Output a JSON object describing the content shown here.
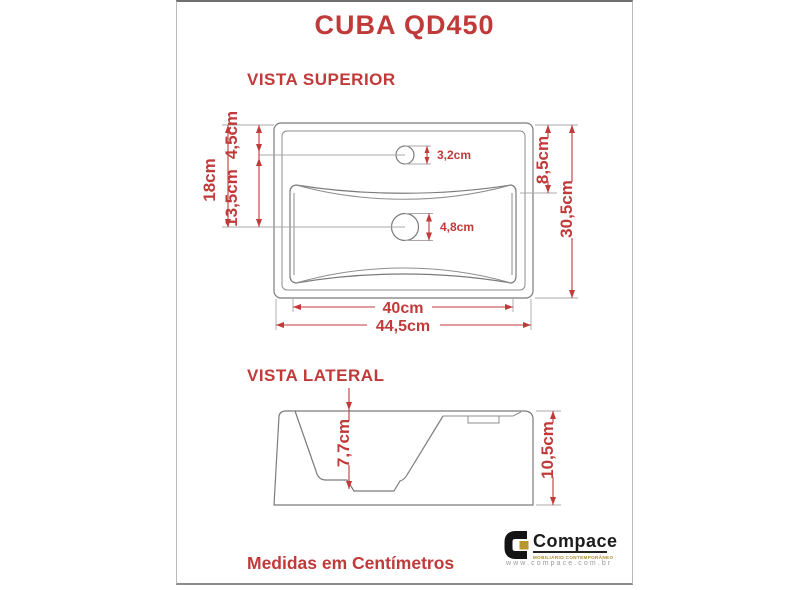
{
  "title": "CUBA QD450",
  "sections": {
    "top_view_label": "VISTA SUPERIOR",
    "side_view_label": "VISTA LATERAL",
    "footer_note": "Medidas em Centímetros"
  },
  "top_view": {
    "outer_width": "44,5cm",
    "inner_width": "40cm",
    "outer_height": "30,5cm",
    "left_height": "18cm",
    "faucet_offset": "4,5cm",
    "drain_offset": "13,5cm",
    "rim_depth": "8,5cm",
    "faucet_hole": "3,2cm",
    "drain_hole": "4,8cm"
  },
  "side_view": {
    "basin_depth": "7,7cm",
    "total_height": "10,5cm"
  },
  "brand": {
    "name": "Compace",
    "tagline": "MOBILIÁRIO CONTEMPORÂNEO",
    "website": "www.compace.com.br"
  },
  "colors": {
    "accent": "#c13a3a",
    "drawing_line": "#7b7b7b",
    "brand_gold": "#b8962e"
  }
}
